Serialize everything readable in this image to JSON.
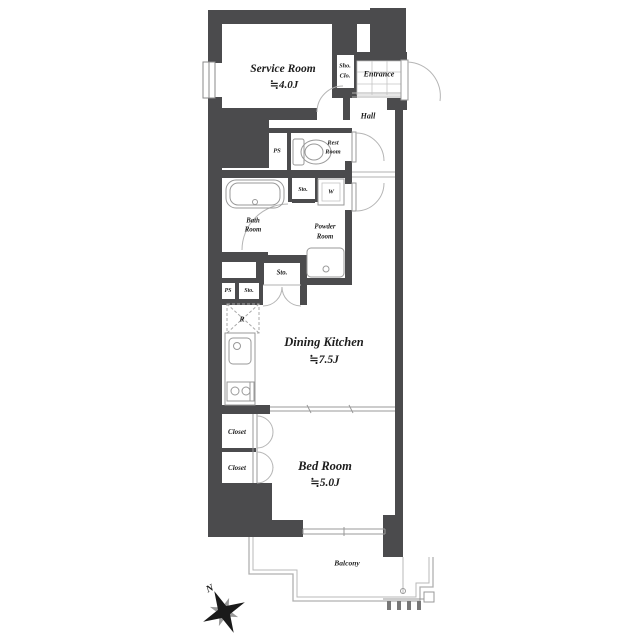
{
  "page": {
    "background": "#ffffff"
  },
  "colors": {
    "wall": "#4b4b4d",
    "fixture_line": "#999999",
    "door_arc": "#b5b5b5",
    "balcony_line": "#b0b0b0",
    "text": "#1d1d1d"
  },
  "compass": {
    "label": "N"
  },
  "rooms": {
    "service_room": {
      "name": "Service Room",
      "size": "≒4.0J"
    },
    "shoe_closet": {
      "line1": "Sho.",
      "line2": "Clo."
    },
    "entrance": {
      "name": "Entrance"
    },
    "hall": {
      "name": "Hall"
    },
    "pipe_space_upper": {
      "name": "PS"
    },
    "rest_room": {
      "line1": "Rest",
      "line2": "Room"
    },
    "storage_top": {
      "name": "Sto."
    },
    "washer": {
      "name": "W"
    },
    "bath_room": {
      "line1": "Bath",
      "line2": "Room"
    },
    "powder_room": {
      "line1": "Powder",
      "line2": "Room"
    },
    "storage_mid": {
      "name": "Sto."
    },
    "pipe_space_lower": {
      "name": "PS"
    },
    "storage_lower": {
      "name": "Sto."
    },
    "refrigerator": {
      "name": "R"
    },
    "dining_kitchen": {
      "name": "Dining Kitchen",
      "size": "≒7.5J"
    },
    "closet_upper": {
      "name": "Closet"
    },
    "closet_lower": {
      "name": "Closet"
    },
    "bed_room": {
      "name": "Bed Room",
      "size": "≒5.0J"
    },
    "balcony": {
      "name": "Balcony"
    }
  }
}
